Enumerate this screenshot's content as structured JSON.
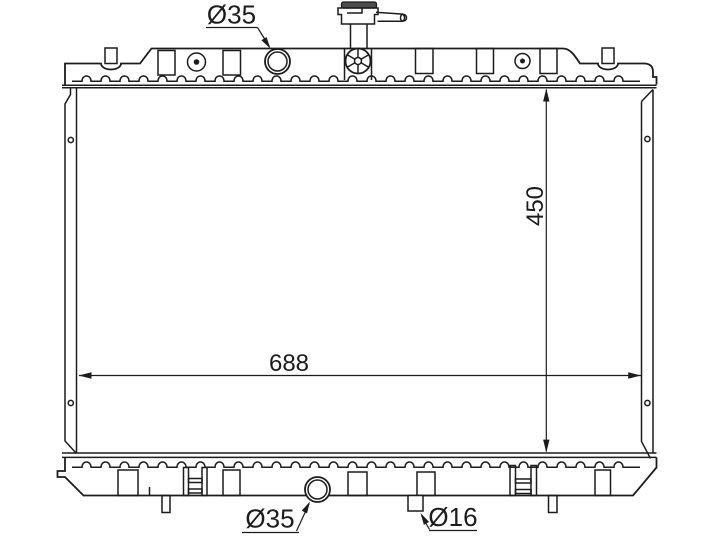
{
  "drawing": {
    "labels": {
      "top_inlet_diameter": "Ø35",
      "core_height": "450",
      "core_width": "688",
      "bottom_outlet_diameter": "Ø35",
      "drain_port_diameter": "Ø16"
    },
    "colors": {
      "line": "#1c1c1c",
      "background": "#ffffff",
      "cap_fill": "#4d4d4d"
    }
  }
}
